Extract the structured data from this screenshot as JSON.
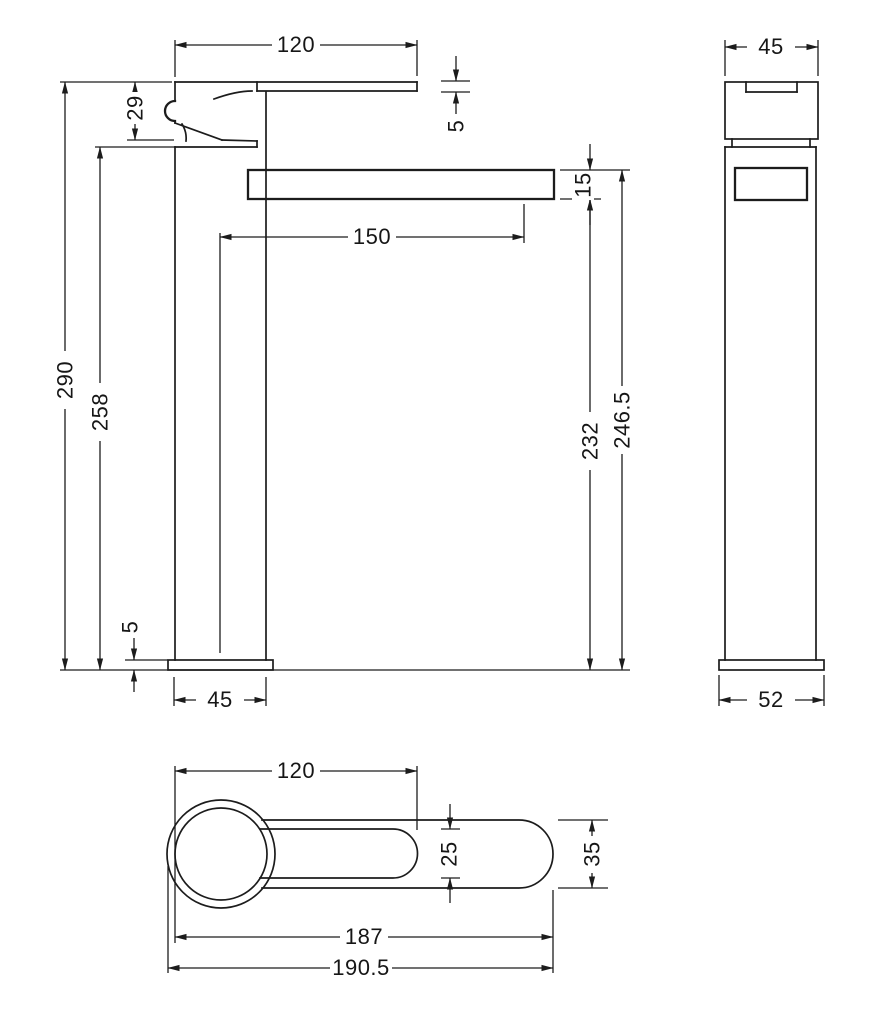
{
  "drawing": {
    "type": "technical-dimension-drawing",
    "subject": "tall single-lever basin mixer tap, three orthographic views",
    "line_color": "#1c1c1c",
    "background_color": "#ffffff",
    "units": "mm"
  },
  "dimensions": {
    "front": {
      "lever_length": "120",
      "lever_thickness": "5",
      "handle_height": "29",
      "overall_height": "290",
      "body_height": "258",
      "spout_reach": "150",
      "spout_thickness": "15",
      "spout_bottom_to_base": "232",
      "spout_top_to_base": "246.5",
      "base_plate_thickness": "5",
      "body_width": "45"
    },
    "side": {
      "body_depth": "45",
      "base_plate_depth": "52"
    },
    "top": {
      "lever_length": "120",
      "lever_width": "25",
      "spout_width": "35",
      "body_to_spout_end": "187",
      "overall_length": "190.5"
    }
  }
}
